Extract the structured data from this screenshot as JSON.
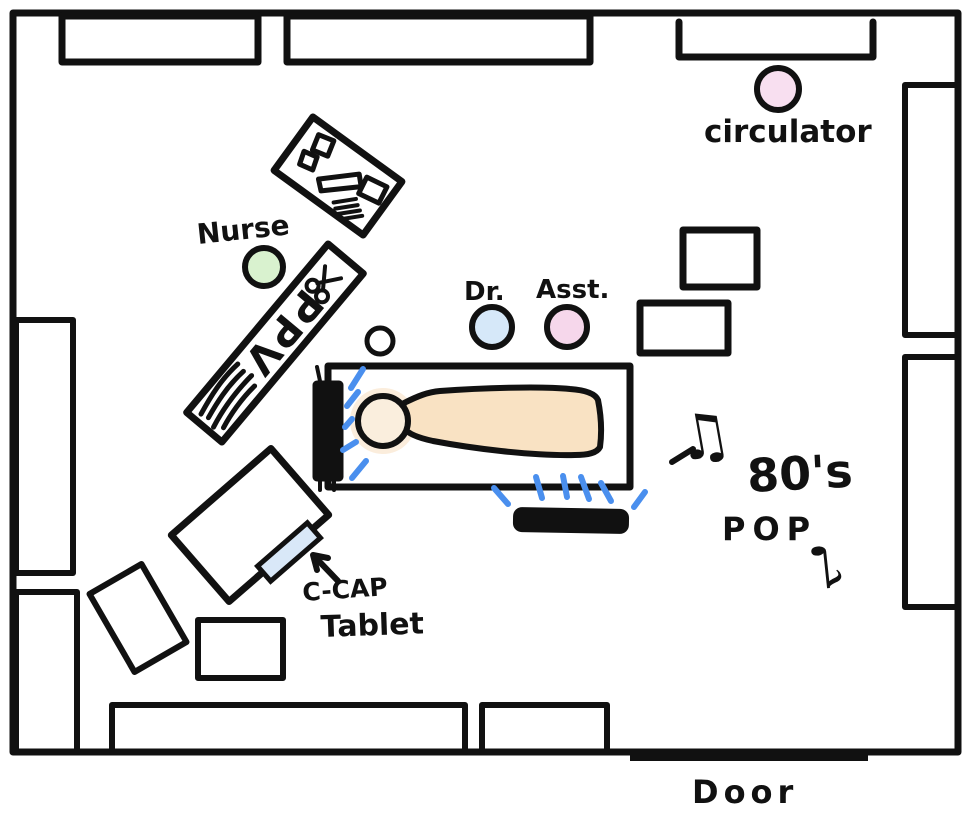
{
  "labels": {
    "nurse": "Nurse",
    "doctor": "Dr.",
    "assistant": "Asst.",
    "circulator": "circulator",
    "ppv": "PPV",
    "ccap": "C-CAP",
    "tablet": "Tablet",
    "music_line1": "80's",
    "music_line2": "POP",
    "door": "Door"
  },
  "icons": {
    "note_beamed": "♫",
    "note_single": "♪",
    "scissors": "✂"
  },
  "colors": {
    "ink": "#111111",
    "dash_blue": "#4a8fee",
    "nurse_green": "#d9f2cf",
    "doctor_blue": "#d6e8f9",
    "assistant_pink": "#f6d7eb",
    "circulator_pink": "#f8dff0",
    "skin_body": "#f9e2c3",
    "skin_head": "#faeedd",
    "skin_halo": "#f7dcb9",
    "tablet_blue": "#d9e8f8"
  }
}
